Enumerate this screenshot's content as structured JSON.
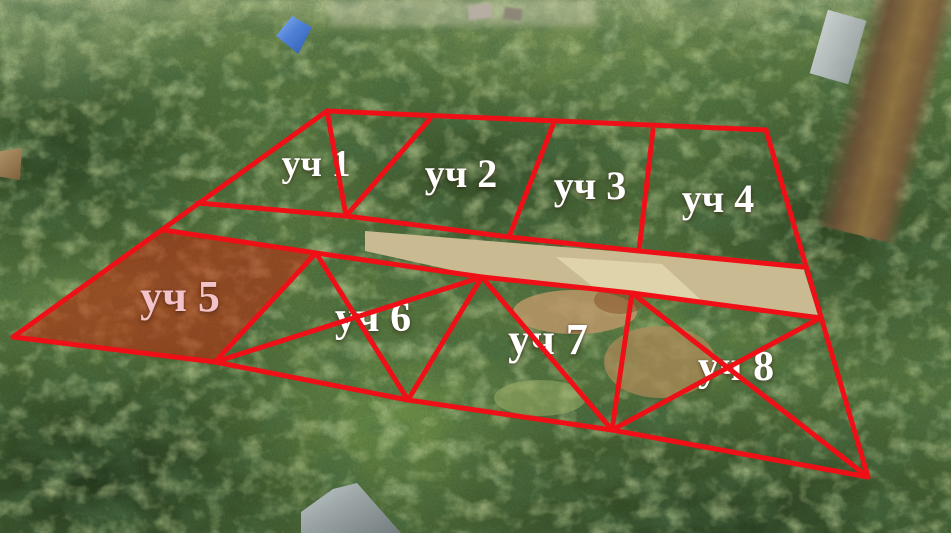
{
  "meta": {
    "description": "Aerial drone photo of a forested area with eight numbered land plots outlined in red",
    "width_px": 951,
    "height_px": 533
  },
  "scene": {
    "landmarks": [
      "top-street-clearing",
      "brown-roof-house",
      "blue-roof-house",
      "left-edge-house",
      "railway-platform",
      "railway-tracks",
      "gravel-road",
      "dirt-field",
      "bottom-house-roof"
    ]
  },
  "overlay": {
    "accent_color": "#ee1016",
    "stroke_width": 5,
    "plot5_fill_color": "rgba(208,32,6,0.48)",
    "plot5_fill_polygon": "163,230 316,253 215,362 13,337",
    "road_polygon": "365,231 700,258 803,267 818,315 632,293 482,277 365,251",
    "road_color": "#c9ba92",
    "road_bright_polygon": "556,257 662,264 702,301 598,291",
    "road_bright_color": "#ded3ab",
    "lines": [
      [
        327,
        111,
        766,
        130
      ],
      [
        327,
        111,
        13,
        337
      ],
      [
        766,
        130,
        868,
        477
      ],
      [
        13,
        337,
        215,
        362
      ],
      [
        215,
        362,
        408,
        400
      ],
      [
        408,
        400,
        612,
        430
      ],
      [
        612,
        430,
        868,
        477
      ],
      [
        198,
        203,
        346,
        216
      ],
      [
        346,
        216,
        509,
        237
      ],
      [
        509,
        237,
        639,
        251
      ],
      [
        639,
        251,
        803,
        267
      ],
      [
        163,
        230,
        316,
        253
      ],
      [
        316,
        253,
        482,
        277
      ],
      [
        482,
        277,
        632,
        293
      ],
      [
        632,
        293,
        820,
        318
      ],
      [
        327,
        111,
        346,
        216
      ],
      [
        430,
        119,
        346,
        216
      ],
      [
        553,
        125,
        509,
        237
      ],
      [
        653,
        130,
        639,
        251
      ],
      [
        316,
        253,
        215,
        362
      ],
      [
        482,
        277,
        408,
        400
      ],
      [
        632,
        293,
        612,
        430
      ],
      [
        316,
        253,
        408,
        400
      ],
      [
        482,
        277,
        215,
        362
      ],
      [
        482,
        277,
        612,
        430
      ],
      [
        632,
        293,
        868,
        477
      ],
      [
        820,
        318,
        612,
        430
      ]
    ]
  },
  "labels": [
    {
      "text": "уч 1",
      "x": 316,
      "y": 164,
      "size": 38,
      "color": "#ffffff"
    },
    {
      "text": "уч 2",
      "x": 461,
      "y": 174,
      "size": 40,
      "color": "#ffffff"
    },
    {
      "text": "уч 3",
      "x": 590,
      "y": 186,
      "size": 40,
      "color": "#ffffff"
    },
    {
      "text": "уч 4",
      "x": 718,
      "y": 199,
      "size": 40,
      "color": "#ffffff"
    },
    {
      "text": "уч 5",
      "x": 180,
      "y": 297,
      "size": 44,
      "color": "#f2c3ca"
    },
    {
      "text": "уч 6",
      "x": 373,
      "y": 318,
      "size": 42,
      "color": "#ffffff"
    },
    {
      "text": "уч 7",
      "x": 548,
      "y": 340,
      "size": 44,
      "color": "#ffffff"
    },
    {
      "text": "уч 8",
      "x": 736,
      "y": 367,
      "size": 42,
      "color": "#ffffff"
    }
  ]
}
